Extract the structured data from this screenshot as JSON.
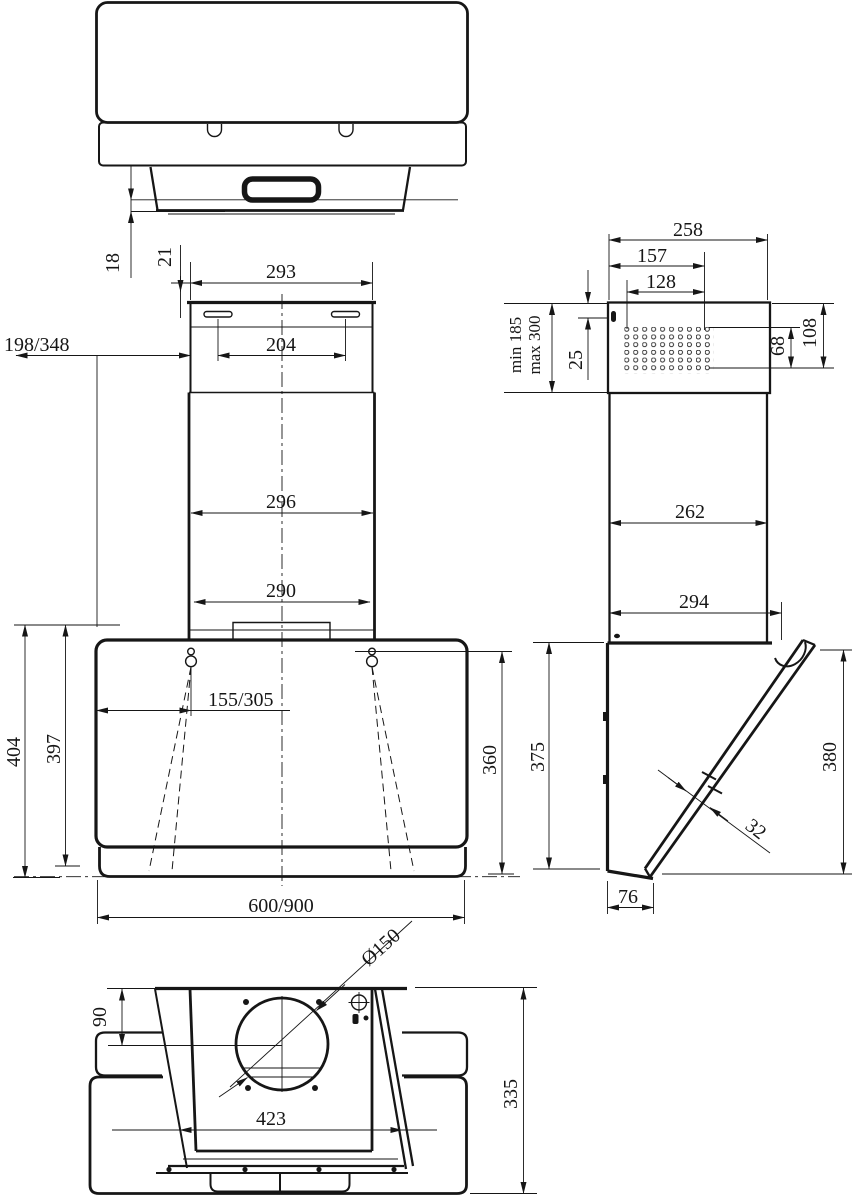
{
  "drawing": {
    "type": "technical-dimension-drawing",
    "subject": "cooker-hood four-view dimensional drawing",
    "colors": {
      "ink": "#161616",
      "paper": "#ffffff"
    },
    "top_view": {
      "labels": {
        "lip_18": "18",
        "lip_21": "21"
      }
    },
    "front_view": {
      "labels": {
        "chimney_top_width": "293",
        "slot_spacing": "204",
        "chimney_offset": "198/348",
        "chimney_mid_width": "296",
        "chimney_bottom_width": "290",
        "hook_offset": "155/305",
        "total_height": "404",
        "body_height": "397",
        "right_height": "360",
        "hood_width": "600/900"
      }
    },
    "side_view": {
      "labels": {
        "top_depth": "258",
        "vent_offset": "157",
        "vent_width": "128",
        "min_height": "min 185",
        "max_height": "max 300",
        "slot_offset": "25",
        "vent_height": "68",
        "top_section_height": "108",
        "mid_depth": "262",
        "bottom_depth": "294",
        "body_height_back": "375",
        "body_height_front": "380",
        "glass_thickness": "32",
        "base_depth": "76"
      }
    },
    "bottom_view": {
      "labels": {
        "duct_diameter": "Ø150",
        "duct_center_offset": "90",
        "opening_width": "423",
        "body_depth": "335"
      }
    }
  }
}
